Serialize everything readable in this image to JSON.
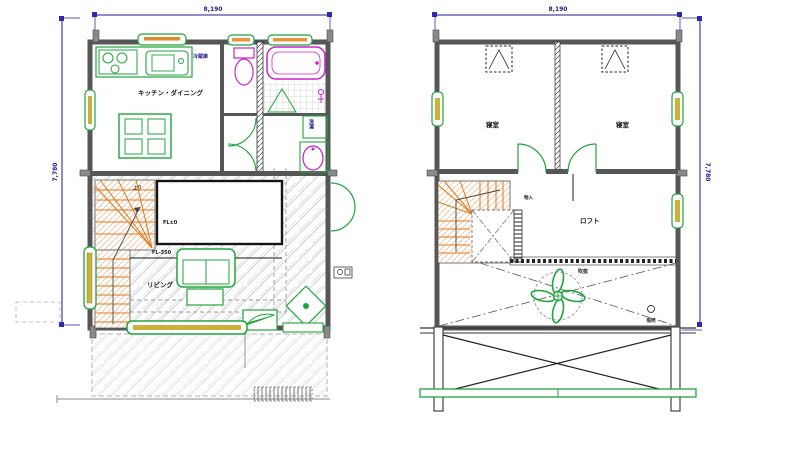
{
  "drawing": {
    "kind": "architectural floor plan, two storeys side by side"
  },
  "colors": {
    "wall": "#565656",
    "furniture_green": "#1fa53c",
    "sanitary_magenta": "#cc22cc",
    "stair_orange": "#e2761b",
    "window_core": "#c9b23a",
    "dimension_blue": "#1c1c8a",
    "hatch_gray": "#cfcfcf"
  },
  "floor1": {
    "dim_top": "8,190",
    "dim_left": "7,780",
    "labels": {
      "kitchen_dining": "キッチン・ダイニング",
      "living": "リビング",
      "refrigerator": "冷蔵庫",
      "laundry": "洗濯",
      "stair_note": "上り",
      "hall_level": "FL±0",
      "living_level": "FL-350"
    }
  },
  "floor2": {
    "dim_top": "8,190",
    "dim_right": "7,780",
    "labels": {
      "bedroom_left": "寝室",
      "bedroom_right": "寝室",
      "loft": "ロフト",
      "void": "吹抜",
      "closet": "物入",
      "light": "照明"
    }
  }
}
